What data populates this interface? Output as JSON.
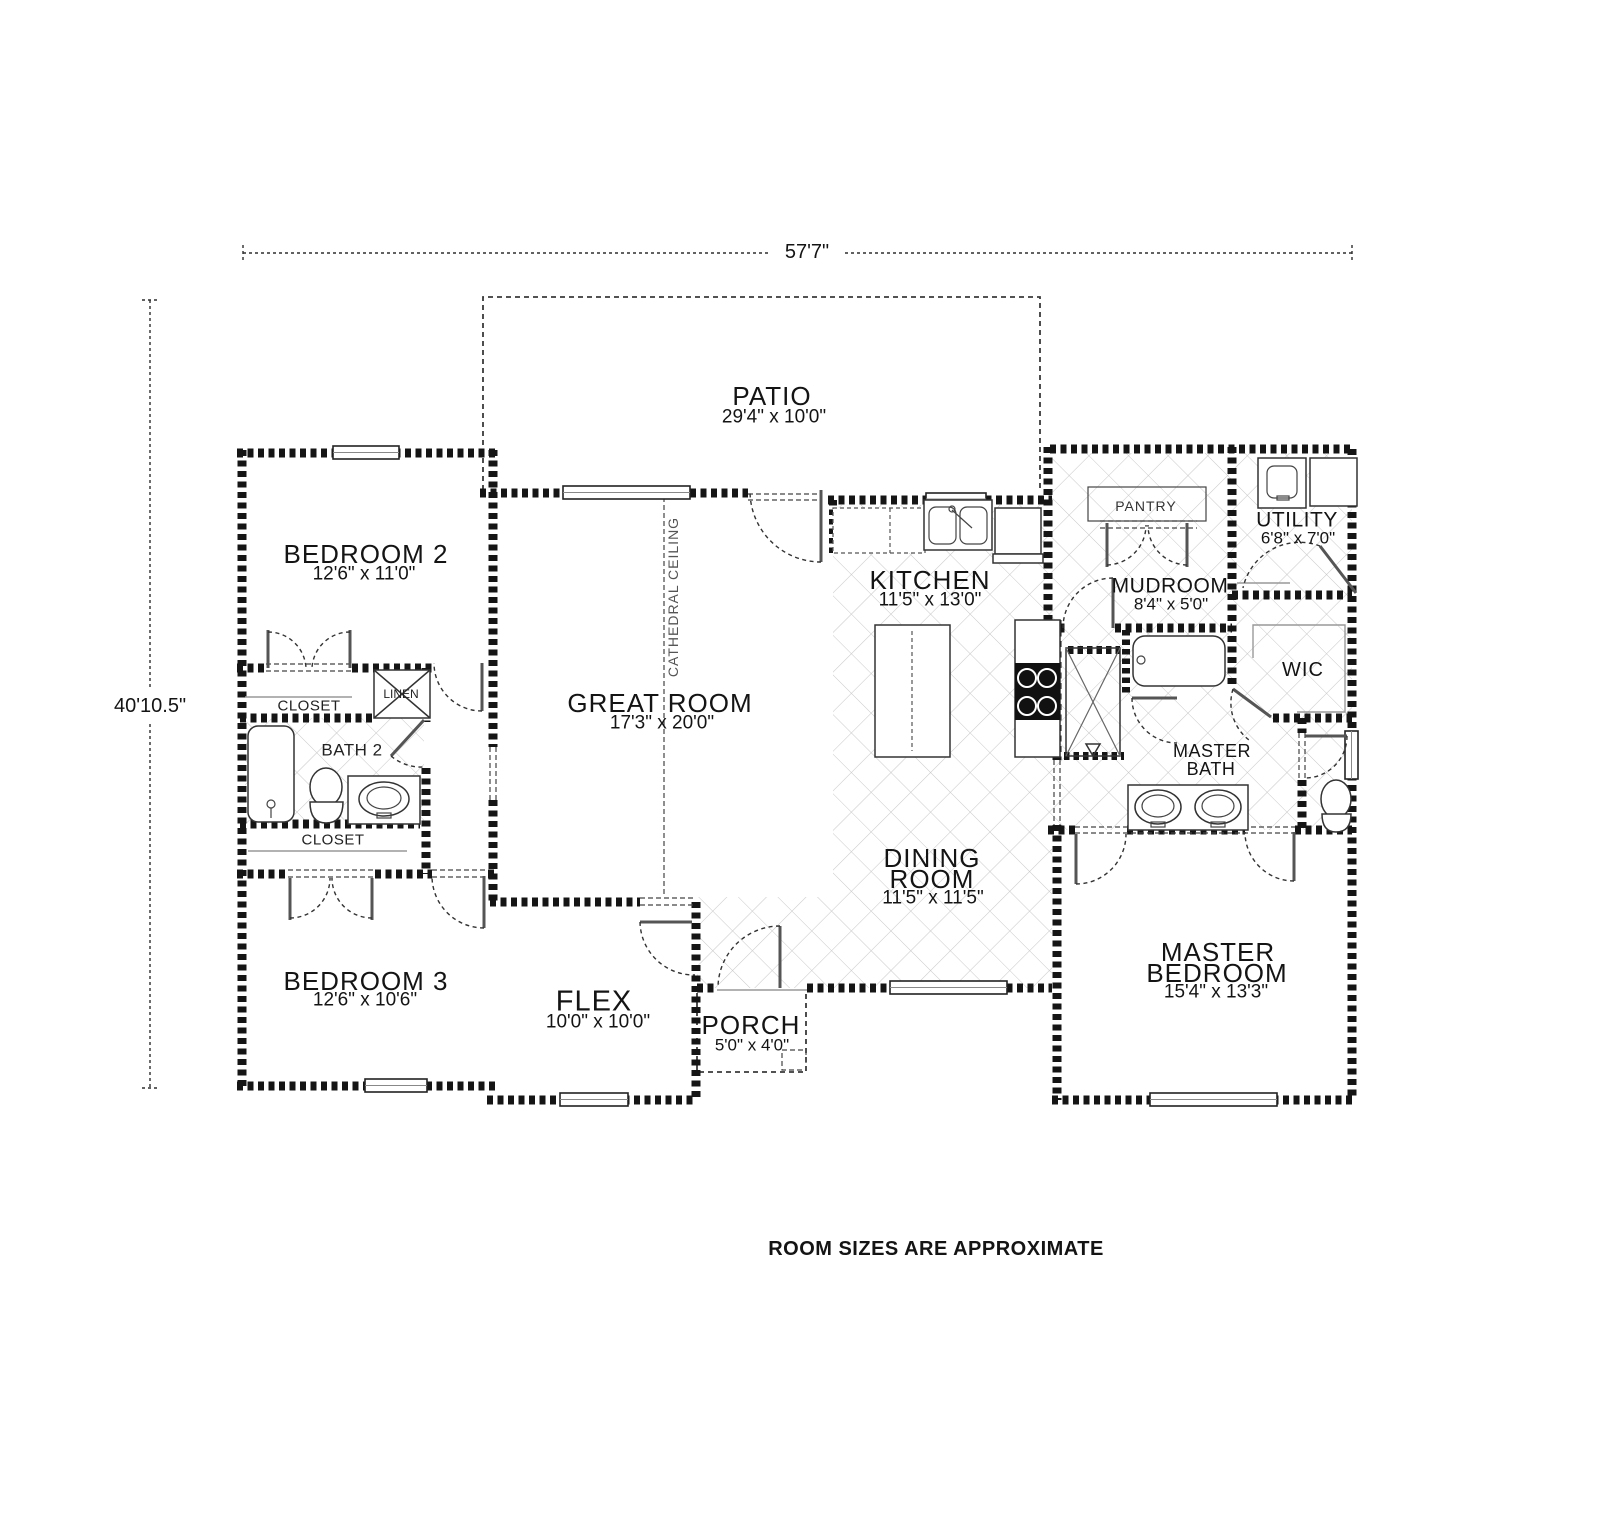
{
  "note": "ROOM SIZES ARE APPROXIMATE",
  "dimensions": {
    "overall_width": "57'7\"",
    "overall_height": "40'10.5\""
  },
  "rooms": {
    "patio": {
      "name": "PATIO",
      "size": "29'4\" x 10'0\""
    },
    "bedroom2": {
      "name": "BEDROOM 2",
      "size": "12'6\" x 11'0\""
    },
    "bedroom3": {
      "name": "BEDROOM 3",
      "size": "12'6\" x 10'6\""
    },
    "great_room": {
      "name": "GREAT ROOM",
      "size": "17'3\" x 20'0\"",
      "ceiling": "CATHEDRAL CEILING"
    },
    "kitchen": {
      "name": "KITCHEN",
      "size": "11'5\" x 13'0\""
    },
    "dining_room": {
      "name_line1": "DINING",
      "name_line2": "ROOM",
      "size": "11'5\" x 11'5\""
    },
    "master_bedroom": {
      "name_line1": "MASTER",
      "name_line2": "BEDROOM",
      "size": "15'4\" x 13'3\""
    },
    "master_bath": {
      "name_line1": "MASTER",
      "name_line2": "BATH"
    },
    "flex": {
      "name": "FLEX",
      "size": "10'0\" x 10'0\""
    },
    "porch": {
      "name": "PORCH",
      "size": "5'0\" x 4'0\""
    },
    "utility": {
      "name": "UTILITY",
      "size": "6'8\" x 7'0\""
    },
    "mudroom": {
      "name": "MUDROOM",
      "size": "8'4\" x 5'0\""
    },
    "wic": {
      "name": "WIC"
    },
    "bath2": {
      "name": "BATH 2"
    },
    "pantry": {
      "name": "PANTRY"
    },
    "linen": {
      "name": "LINEN"
    },
    "closet_bedroom2": {
      "name": "CLOSET"
    },
    "closet_bedroom3": {
      "name": "CLOSET"
    }
  }
}
